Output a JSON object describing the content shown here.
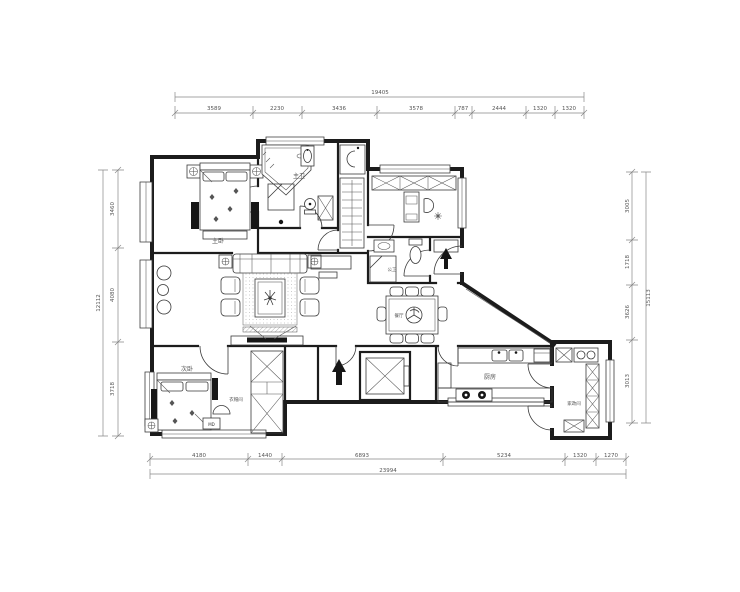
{
  "meta": {
    "type": "architectural-floor-plan",
    "background": "#ffffff",
    "wall_color": "#1c1c1c",
    "furniture_line_color": "#3a3a3a",
    "dimension_color": "#555555"
  },
  "dimensions": {
    "top": {
      "total": "19405",
      "segments": [
        "3589",
        "2230",
        "3436",
        "3578",
        "787",
        "2444",
        "1320",
        "1320"
      ]
    },
    "bottom": {
      "total": "23994",
      "segments": [
        "4180",
        "1440",
        "6893",
        "5234",
        "1320",
        "1270"
      ]
    },
    "left": {
      "total": "12112",
      "segments": [
        "3460",
        "4080",
        "3718"
      ]
    },
    "right": {
      "total": "15113",
      "segments": [
        "3005",
        "1718",
        "3626",
        "3013"
      ]
    }
  },
  "labels": {
    "master_bedroom": "主卧",
    "master_bath": "主卫",
    "guest_bath": "公卫",
    "dining_room": "餐厅",
    "second_bedroom": "次卧",
    "walk_in_closet": "衣帽间",
    "kitchen": "厨房",
    "utility_room": "家政间",
    "md_cabinet": "MD"
  },
  "icons": {
    "entry_arrow": "solid black arrow pointing into the flat",
    "plant": "potted plant on coffee table",
    "lazy_susan": "rotating tray on dining table"
  }
}
